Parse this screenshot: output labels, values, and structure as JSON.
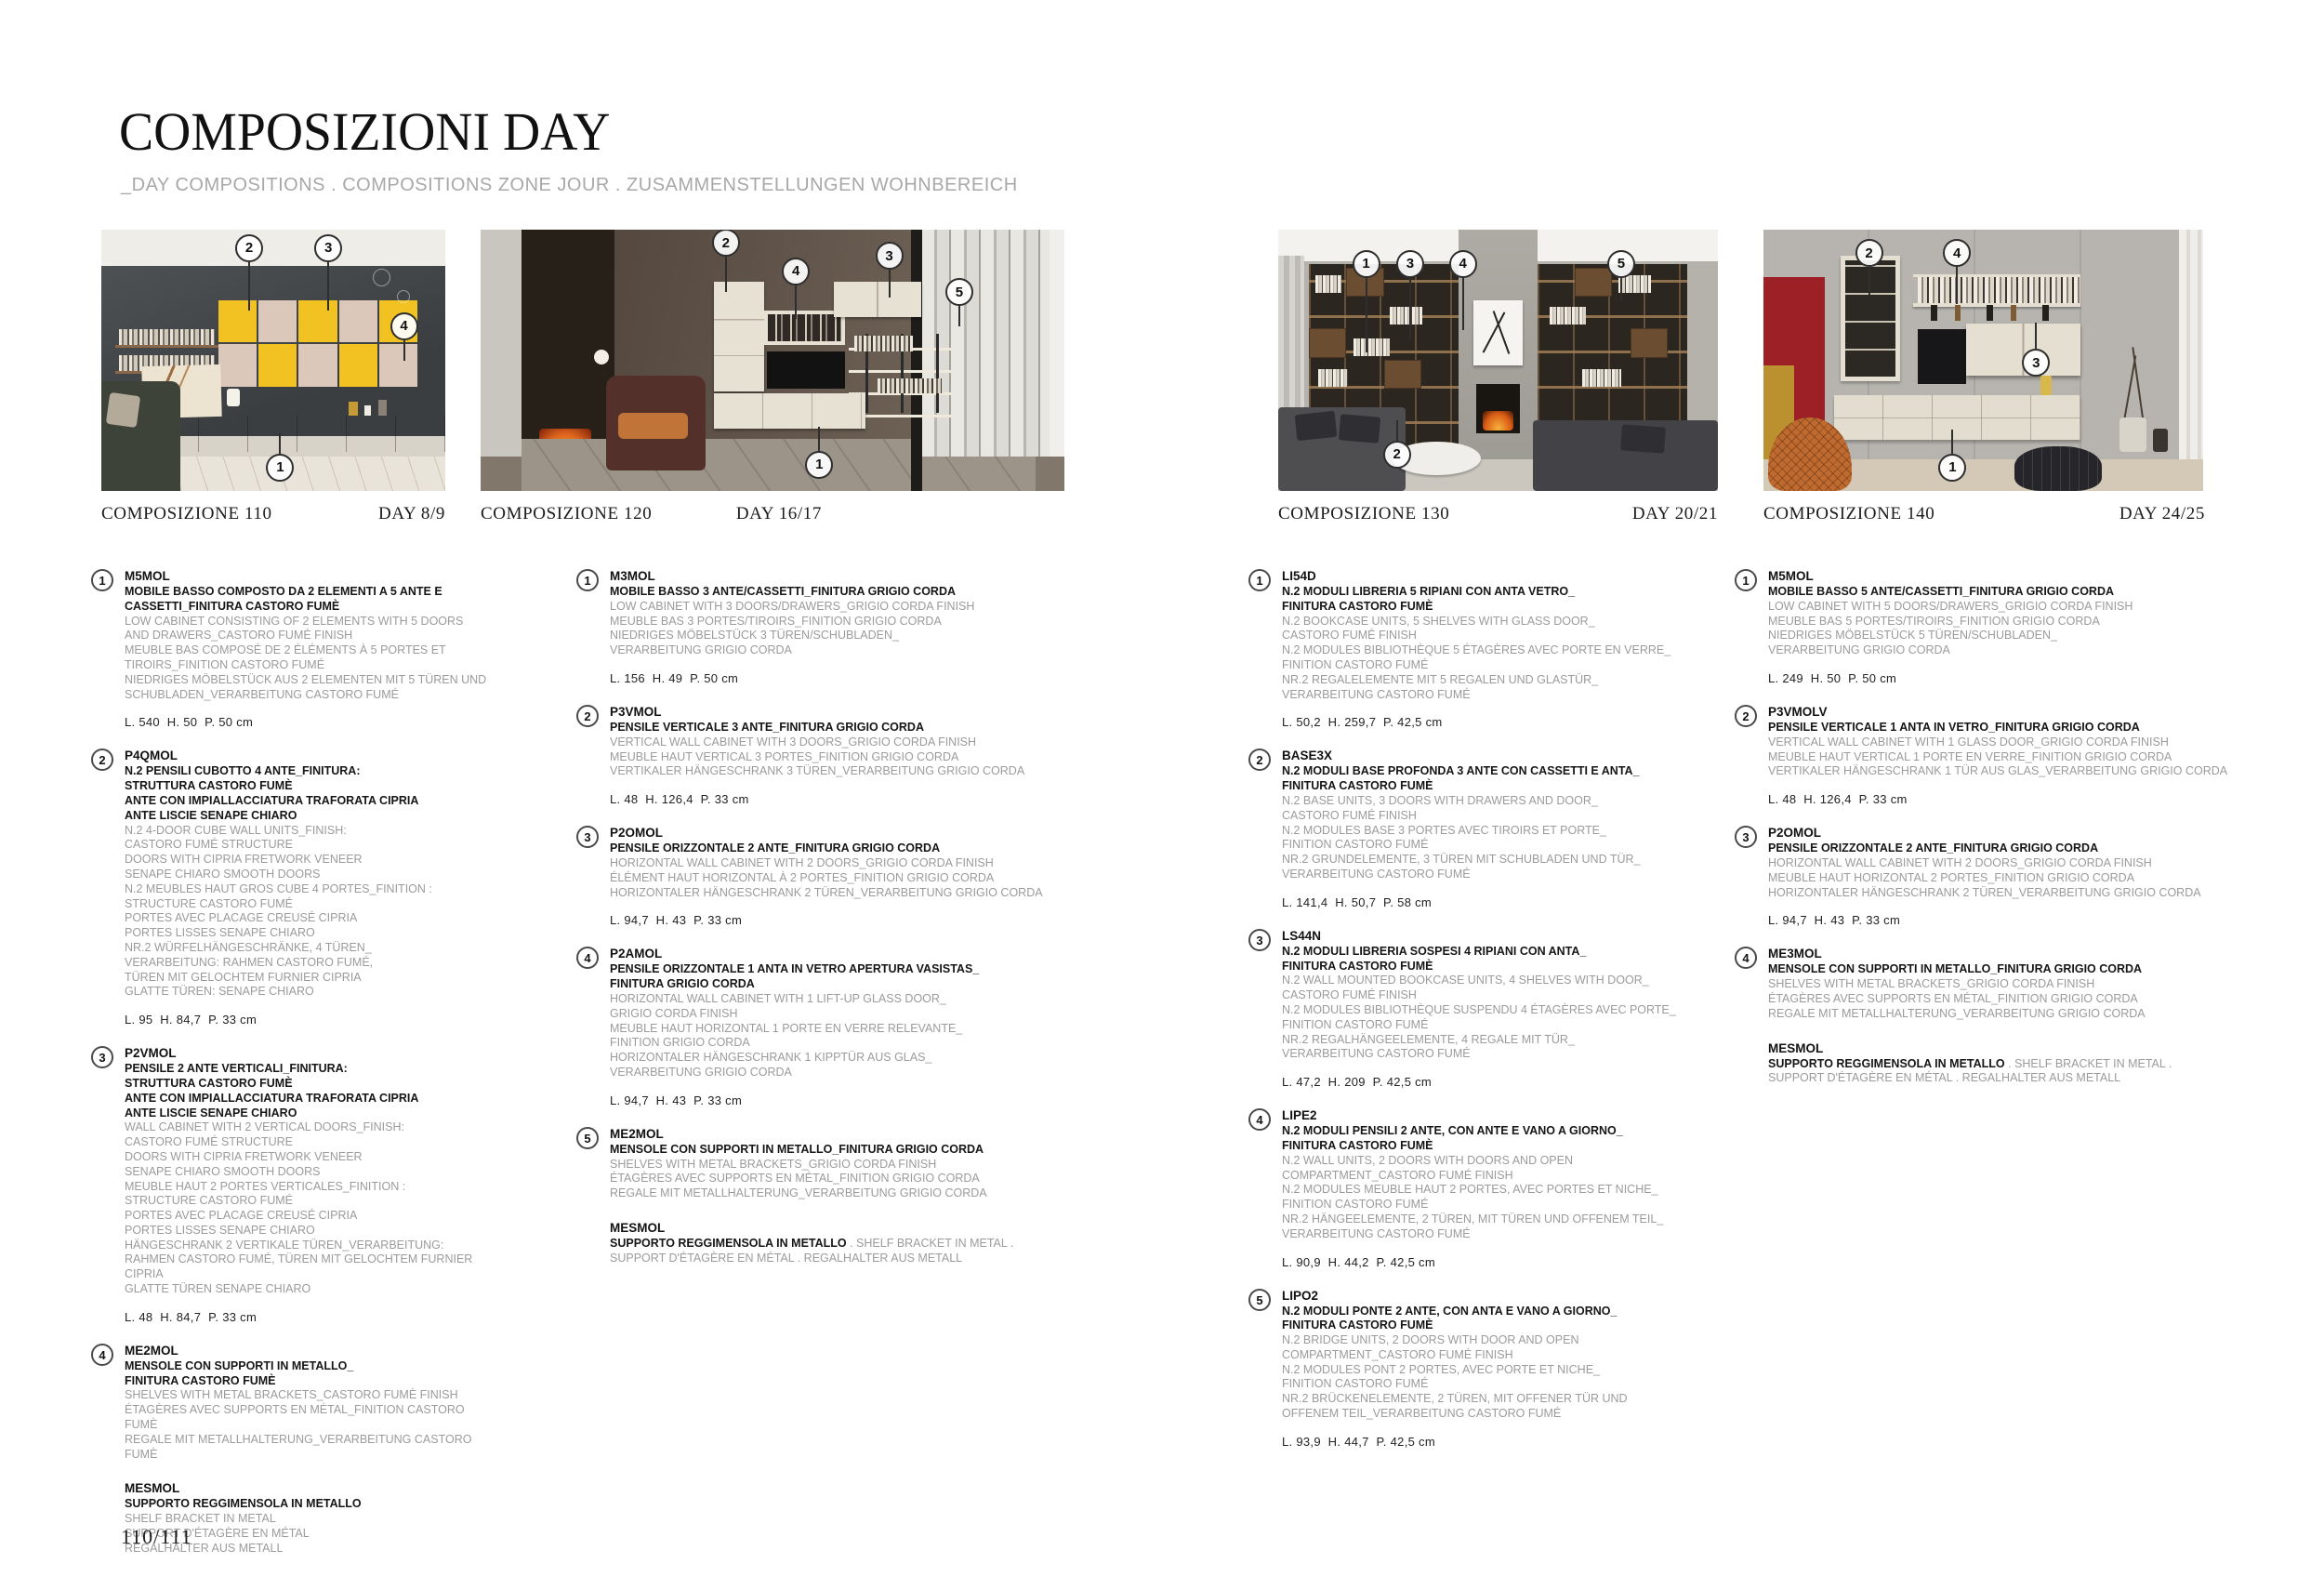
{
  "page": {
    "title": "COMPOSIZIONI DAY",
    "subtitle": "_DAY COMPOSITIONS . COMPOSITIONS ZONE JOUR . ZUSAMMENSTELLUNGEN WOHNBEREICH",
    "page_number": "110/111"
  },
  "palette": {
    "yellow_cube": "#f2c122",
    "blush_cube": "#dcc8ba",
    "wood_brown": "#7c5c3d",
    "dark_wall": "#3f4345",
    "cream_unit": "#e7e1d4",
    "red_panel": "#9c2026",
    "mustard_panel": "#bb9130",
    "fire_orange": "#e0661d",
    "text_gray": "#9b9b9b"
  },
  "compositions": [
    {
      "name": "COMPOSIZIONE 110",
      "day": "DAY 8/9",
      "callouts": [
        {
          "n": "2",
          "x": 43,
          "y": 7,
          "dir": "down",
          "len": 52
        },
        {
          "n": "3",
          "x": 66,
          "y": 7,
          "dir": "down",
          "len": 52
        },
        {
          "n": "4",
          "x": 88,
          "y": 37,
          "dir": "down",
          "len": 22
        },
        {
          "n": "1",
          "x": 52,
          "y": 91,
          "dir": "up",
          "len": 22
        }
      ],
      "items": [
        {
          "num": "1",
          "code": "M5MOL",
          "title": "MOBILE BASSO COMPOSTO DA 2 ELEMENTI A 5 ANTE E\nCASSETTI_FINITURA CASTORO FUMÈ",
          "desc": "LOW CABINET CONSISTING OF 2 ELEMENTS WITH 5 DOORS\nAND DRAWERS_CASTORO FUMÉ FINISH\nMEUBLE BAS COMPOSÉ DE 2 ÉLÉMENTS À 5 PORTES ET\nTIROIRS_FINITION CASTORO FUMÉ\nNIEDRIGES MÖBELSTÜCK AUS 2 ELEMENTEN MIT 5 TÜREN UND\nSCHUBLADEN_VERARBEITUNG CASTORO FUMÉ",
          "dims": "L. 540  H. 50  P. 50 cm"
        },
        {
          "num": "2",
          "code": "P4QMOL",
          "title": "N.2 PENSILI CUBOTTO 4 ANTE_FINITURA:\nSTRUTTURA CASTORO FUMÈ\nANTE CON IMPIALLACCIATURA TRAFORATA CIPRIA\nANTE LISCIE SENAPE CHIARO",
          "desc": "N.2 4-DOOR CUBE WALL UNITS_FINISH:\nCASTORO FUMÉ STRUCTURE\nDOORS WITH CIPRIA FRETWORK VENEER\nSENAPE CHIARO SMOOTH DOORS\nN.2 MEUBLES HAUT GROS CUBE 4 PORTES_FINITION :\nSTRUCTURE CASTORO FUMÉ\nPORTES AVEC PLACAGE CREUSÉ CIPRIA\nPORTES LISSES SENAPE CHIARO\nNR.2 WÜRFELHÄNGESCHRÄNKE, 4 TÜREN_\nVERARBEITUNG: RAHMEN CASTORO FUMÉ,\nTÜREN MIT GELOCHTEM FURNIER CIPRIA\nGLATTE TÜREN: SENAPE CHIARO",
          "dims": "L. 95  H. 84,7  P. 33 cm"
        },
        {
          "num": "3",
          "code": "P2VMOL",
          "title": "PENSILE 2 ANTE VERTICALI_FINITURA:\nSTRUTTURA CASTORO FUMÈ\nANTE CON IMPIALLACCIATURA TRAFORATA CIPRIA\nANTE LISCIE SENAPE CHIARO",
          "desc": "WALL CABINET WITH 2 VERTICAL DOORS_FINISH:\nCASTORO FUMÉ STRUCTURE\nDOORS WITH CIPRIA FRETWORK VENEER\nSENAPE CHIARO SMOOTH DOORS\nMEUBLE HAUT 2 PORTES VERTICALES_FINITION :\nSTRUCTURE CASTORO FUMÉ\nPORTES AVEC PLACAGE CREUSÉ CIPRIA\nPORTES LISSES SENAPE CHIARO\nHÄNGESCHRANK 2 VERTIKALE TÜREN_VERARBEITUNG:\nRAHMEN CASTORO FUMÉ, TÜREN MIT GELOCHTEM FURNIER CIPRIA\nGLATTE TÜREN SENAPE CHIARO",
          "dims": "L. 48  H. 84,7  P. 33 cm"
        },
        {
          "num": "4",
          "code": "ME2MOL",
          "title": "MENSOLE CON SUPPORTI IN METALLO_\nFINITURA CASTORO FUMÈ",
          "desc": "SHELVES WITH METAL BRACKETS_CASTORO FUMÈ FINISH\nÉTAGÈRES AVEC SUPPORTS EN MÉTAL_FINITION CASTORO FUMÈ\nREGALE MIT METALLHALTERUNG_VERARBEITUNG CASTORO FUMÈ"
        },
        {
          "num": "",
          "code": "MESMOL",
          "title": "SUPPORTO REGGIMENSOLA IN METALLO",
          "desc": "SHELF BRACKET IN METAL\nSUPPORT D'ÉTAGÈRE EN MÉTAL\nREGALHALTER AUS METALL"
        }
      ]
    },
    {
      "name": "COMPOSIZIONE 120",
      "day": "DAY 16/17",
      "callouts": [
        {
          "n": "2",
          "x": 42,
          "y": 5,
          "dir": "down",
          "len": 38
        },
        {
          "n": "4",
          "x": 54,
          "y": 16,
          "dir": "down",
          "len": 36
        },
        {
          "n": "3",
          "x": 70,
          "y": 10,
          "dir": "down",
          "len": 30
        },
        {
          "n": "5",
          "x": 82,
          "y": 24,
          "dir": "down",
          "len": 22
        },
        {
          "n": "1",
          "x": 58,
          "y": 90,
          "dir": "up",
          "len": 26
        }
      ],
      "items": [
        {
          "num": "1",
          "code": "M3MOL",
          "title": "MOBILE BASSO 3 ANTE/CASSETTI_FINITURA GRIGIO CORDA",
          "desc": "LOW CABINET WITH 3 DOORS/DRAWERS_GRIGIO CORDA FINISH\nMEUBLE BAS 3 PORTES/TIROIRS_FINITION GRIGIO CORDA\nNIEDRIGES MÖBELSTÜCK 3 TÜREN/SCHUBLADEN_\nVERARBEITUNG GRIGIO CORDA",
          "dims": "L. 156  H. 49  P. 50 cm"
        },
        {
          "num": "2",
          "code": "P3VMOL",
          "title": "PENSILE VERTICALE 3 ANTE_FINITURA GRIGIO CORDA",
          "desc": "VERTICAL WALL CABINET WITH 3 DOORS_GRIGIO CORDA FINISH\nMEUBLE HAUT VERTICAL 3 PORTES_FINITION GRIGIO CORDA\nVERTIKALER HÄNGESCHRANK 3 TÜREN_VERARBEITUNG GRIGIO CORDA",
          "dims": "L. 48  H. 126,4  P. 33 cm"
        },
        {
          "num": "3",
          "code": "P2OMOL",
          "title": "PENSILE ORIZZONTALE 2 ANTE_FINITURA GRIGIO CORDA",
          "desc": "HORIZONTAL WALL CABINET WITH 2 DOORS_GRIGIO CORDA FINISH\nÉLÉMENT HAUT HORIZONTAL À 2 PORTES_FINITION GRIGIO CORDA\nHORIZONTALER HÄNGESCHRANK 2 TÜREN_VERARBEITUNG GRIGIO CORDA",
          "dims": "L. 94,7  H. 43  P. 33 cm"
        },
        {
          "num": "4",
          "code": "P2AMOL",
          "title": "PENSILE ORIZZONTALE 1 ANTA IN VETRO APERTURA VASISTAS_\nFINITURA GRIGIO CORDA",
          "desc": "HORIZONTAL WALL CABINET WITH 1 LIFT-UP GLASS DOOR_\nGRIGIO CORDA FINISH\nMEUBLE HAUT HORIZONTAL 1 PORTE EN VERRE RELEVANTE_\nFINITION GRIGIO CORDA\nHORIZONTALER HÄNGESCHRANK 1 KIPPTÜR AUS GLAS_\nVERARBEITUNG GRIGIO CORDA",
          "dims": "L. 94,7  H. 43  P. 33 cm"
        },
        {
          "num": "5",
          "code": "ME2MOL",
          "title": "MENSOLE CON SUPPORTI IN METALLO_FINITURA GRIGIO CORDA",
          "desc": "SHELVES WITH METAL BRACKETS_GRIGIO CORDA FINISH\nÉTAGÈRES AVEC SUPPORTS EN MÉTAL_FINITION GRIGIO CORDA\nREGALE MIT METALLHALTERUNG_VERARBEITUNG GRIGIO CORDA"
        },
        {
          "num": "",
          "code": "MESMOL",
          "title": "SUPPORTO REGGIMENSOLA IN METALLO",
          "title_suffix": " . SHELF BRACKET IN METAL .",
          "desc": "SUPPORT D'ÉTAGÈRE EN MÉTAL . REGALHALTER AUS METALL"
        }
      ]
    },
    {
      "name": "COMPOSIZIONE 130",
      "day": "DAY 20/21",
      "callouts": [
        {
          "n": "1",
          "x": 20,
          "y": 13,
          "dir": "down",
          "len": 80
        },
        {
          "n": "3",
          "x": 30,
          "y": 13,
          "dir": "down",
          "len": 66
        },
        {
          "n": "4",
          "x": 42,
          "y": 13,
          "dir": "down",
          "len": 56
        },
        {
          "n": "5",
          "x": 78,
          "y": 13,
          "dir": "down",
          "len": 26
        },
        {
          "n": "2",
          "x": 27,
          "y": 86,
          "dir": "up",
          "len": 22
        }
      ],
      "items": [
        {
          "num": "1",
          "code": "LI54D",
          "title": "N.2 MODULI LIBRERIA 5 RIPIANI CON ANTA VETRO_\nFINITURA CASTORO FUMÈ",
          "desc": "N.2 BOOKCASE UNITS, 5 SHELVES WITH GLASS DOOR_\nCASTORO FUMÉ FINISH\nN.2 MODULES BIBLIOTHÈQUE 5 ÉTAGÈRES AVEC PORTE EN VERRE_\nFINITION CASTORO FUMÉ\nNR.2 REGALELEMENTE MIT 5 REGALEN UND GLASTÜR_\nVERARBEITUNG CASTORO FUMÉ",
          "dims": "L. 50,2  H. 259,7  P. 42,5 cm"
        },
        {
          "num": "2",
          "code": "BASE3X",
          "title": "N.2 MODULI BASE PROFONDA 3 ANTE CON CASSETTI E ANTA_\nFINITURA CASTORO FUMÈ",
          "desc": "N.2 BASE UNITS, 3 DOORS WITH DRAWERS AND DOOR_\nCASTORO FUMÉ FINISH\nN.2 MODULES BASE 3 PORTES AVEC TIROIRS ET PORTE_\nFINITION CASTORO FUMÉ\nNR.2 GRUNDELEMENTE, 3 TÜREN MIT SCHUBLADEN UND TÜR_\nVERARBEITUNG CASTORO FUMÉ",
          "dims": "L. 141,4  H. 50,7  P. 58 cm"
        },
        {
          "num": "3",
          "code": "LS44N",
          "title": "N.2 MODULI LIBRERIA SOSPESI 4 RIPIANI CON ANTA_\nFINITURA CASTORO FUMÈ",
          "desc": "N.2 WALL MOUNTED BOOKCASE UNITS, 4 SHELVES WITH DOOR_\nCASTORO FUMÉ FINISH\nN.2 MODULES BIBLIOTHÈQUE SUSPENDU 4 ÉTAGÈRES AVEC PORTE_\nFINITION CASTORO FUMÉ\nNR.2 REGALHÄNGEELEMENTE, 4 REGALE MIT TÜR_\nVERARBEITUNG CASTORO FUMÉ",
          "dims": "L. 47,2  H. 209  P. 42,5 cm"
        },
        {
          "num": "4",
          "code": "LIPE2",
          "title": "N.2 MODULI PENSILI 2 ANTE, CON ANTE E VANO A GIORNO_\nFINITURA CASTORO FUMÈ",
          "desc": "N.2 WALL UNITS, 2 DOORS WITH DOORS AND OPEN\nCOMPARTMENT_CASTORO FUMÉ FINISH\nN.2 MODULES MEUBLE HAUT 2 PORTES, AVEC PORTES ET NICHE_\nFINITION CASTORO FUMÉ\nNR.2 HÄNGEELEMENTE, 2 TÜREN, MIT TÜREN UND OFFENEM TEIL_\nVERARBEITUNG CASTORO FUMÉ",
          "dims": "L. 90,9  H. 44,2  P. 42,5 cm"
        },
        {
          "num": "5",
          "code": "LIPO2",
          "title": "N.2 MODULI PONTE 2 ANTE, CON ANTA E VANO A GIORNO_\nFINITURA CASTORO FUMÈ",
          "desc": "N.2 BRIDGE UNITS, 2 DOORS WITH DOOR AND OPEN\nCOMPARTMENT_CASTORO FUMÉ FINISH\nN.2 MODULES PONT 2 PORTES, AVEC PORTE ET NICHE_\nFINITION CASTORO FUMÉ\nNR.2 BRÜCKENELEMENTE, 2 TÜREN, MIT OFFENER TÜR UND\nOFFENEM TEIL_VERARBEITUNG CASTORO FUMÉ",
          "dims": "L. 93,9  H. 44,7  P. 42,5 cm"
        }
      ]
    },
    {
      "name": "COMPOSIZIONE 140",
      "day": "DAY 24/25",
      "callouts": [
        {
          "n": "2",
          "x": 24,
          "y": 9,
          "dir": "down",
          "len": 30
        },
        {
          "n": "4",
          "x": 44,
          "y": 9,
          "dir": "down",
          "len": 40
        },
        {
          "n": "3",
          "x": 62,
          "y": 51,
          "dir": "up",
          "len": 28
        },
        {
          "n": "1",
          "x": 43,
          "y": 91,
          "dir": "up",
          "len": 26
        }
      ],
      "items": [
        {
          "num": "1",
          "code": "M5MOL",
          "title": "MOBILE BASSO 5 ANTE/CASSETTI_FINITURA GRIGIO CORDA",
          "desc": "LOW CABINET WITH 5 DOORS/DRAWERS_GRIGIO CORDA FINISH\nMEUBLE BAS 5 PORTES/TIROIRS_FINITION GRIGIO CORDA\nNIEDRIGES MÖBELSTÜCK 5 TÜREN/SCHUBLADEN_\nVERARBEITUNG GRIGIO CORDA",
          "dims": "L. 249  H. 50  P. 50 cm"
        },
        {
          "num": "2",
          "code": "P3VMOLV",
          "title": "PENSILE VERTICALE 1 ANTA IN VETRO_FINITURA GRIGIO CORDA",
          "desc": "VERTICAL WALL CABINET WITH 1 GLASS DOOR_GRIGIO CORDA FINISH\nMEUBLE HAUT VERTICAL 1 PORTE EN VERRE_FINITION GRIGIO CORDA\nVERTIKALER HÄNGESCHRANK 1 TÜR AUS GLAS_VERARBEITUNG GRIGIO CORDA",
          "dims": "L. 48  H. 126,4  P. 33 cm"
        },
        {
          "num": "3",
          "code": "P2OMOL",
          "title": "PENSILE ORIZZONTALE 2 ANTE_FINITURA GRIGIO CORDA",
          "desc": "HORIZONTAL WALL CABINET WITH 2 DOORS_GRIGIO CORDA FINISH\nMEUBLE HAUT HORIZONTAL 2 PORTES_FINITION GRIGIO CORDA\nHORIZONTALER HÄNGESCHRANK 2 TÜREN_VERARBEITUNG GRIGIO CORDA",
          "dims": "L. 94,7  H. 43  P. 33 cm"
        },
        {
          "num": "4",
          "code": "ME3MOL",
          "title": "MENSOLE CON SUPPORTI IN METALLO_FINITURA GRIGIO CORDA",
          "desc": "SHELVES WITH METAL BRACKETS_GRIGIO CORDA FINISH\nÉTAGÈRES AVEC SUPPORTS EN MÉTAL_FINITION GRIGIO CORDA\nREGALE MIT METALLHALTERUNG_VERARBEITUNG GRIGIO CORDA"
        },
        {
          "num": "",
          "code": "MESMOL",
          "title": "SUPPORTO REGGIMENSOLA IN METALLO",
          "title_suffix": " . SHELF BRACKET IN METAL .",
          "desc": "SUPPORT D'ÉTAGÈRE EN MÉTAL . REGALHALTER AUS METALL"
        }
      ]
    }
  ]
}
